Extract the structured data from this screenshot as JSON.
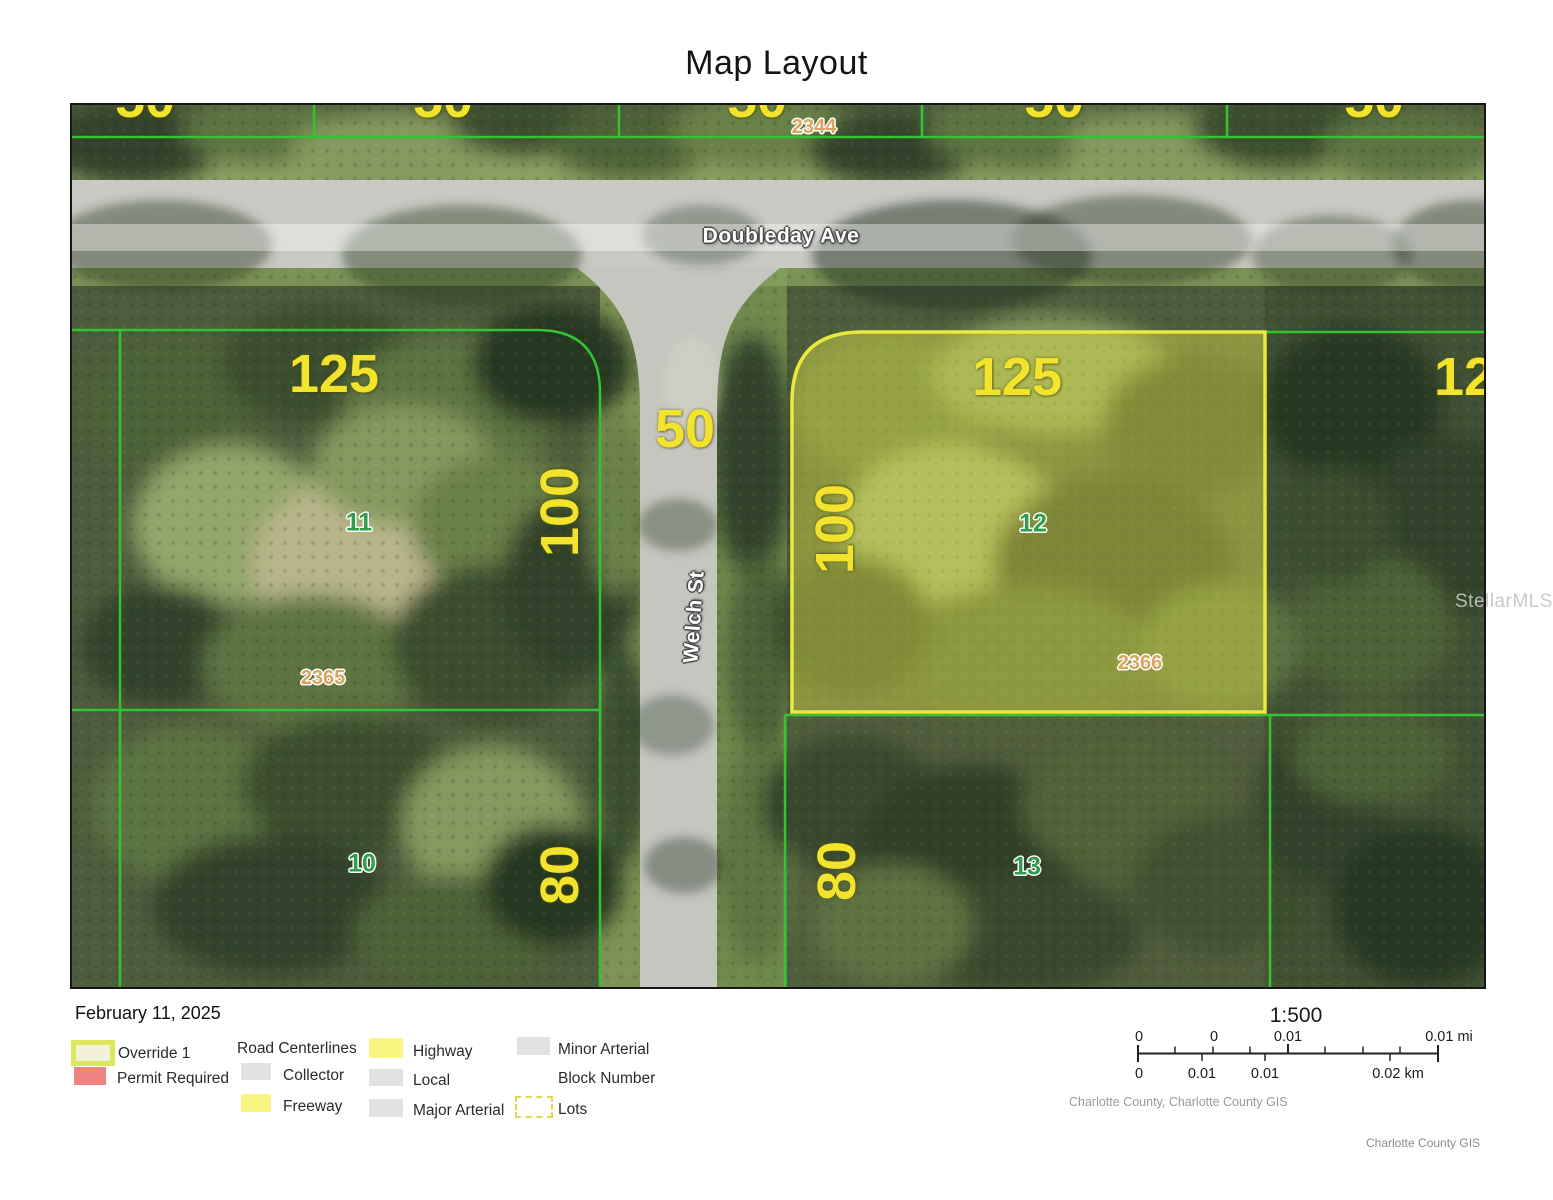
{
  "title": "Map Layout",
  "map": {
    "streets": {
      "horizontal": "Doubleday Ave",
      "vertical": "Welch St"
    },
    "edge_dimension": "50",
    "road_dimension": "50",
    "blocks": {
      "top": "2344"
    },
    "parcels": {
      "lot11": {
        "width": "125",
        "depth": "100",
        "lot": "11",
        "block": "2365"
      },
      "lot12": {
        "width": "125",
        "depth": "100",
        "lot": "12",
        "block": "2366",
        "highlighted": true
      },
      "lot10": {
        "lot": "10",
        "depth": "80"
      },
      "lot13": {
        "lot": "13",
        "depth": "80"
      },
      "right_partial_dimension": "125"
    },
    "watermark": "StellarMLS",
    "colors": {
      "dimension_label": "#f2e32c",
      "lot_label": "#2f9e4a",
      "block_label": "#d9a45f",
      "parcel_line": "#33c433",
      "highlight_fill": "rgba(228,228,72,0.42)",
      "highlight_stroke": "#ebe83e"
    }
  },
  "legend": {
    "date": "February 11, 2025",
    "items": [
      {
        "label": "Override 1",
        "swatch": "override"
      },
      {
        "label": "Permit Required",
        "swatch": "permit"
      },
      {
        "label": "Road Centerlines",
        "swatch": "none"
      },
      {
        "label": "Collector",
        "swatch": "gray"
      },
      {
        "label": "Freeway",
        "swatch": "yellow"
      },
      {
        "label": "Highway",
        "swatch": "yellow"
      },
      {
        "label": "Local",
        "swatch": "gray"
      },
      {
        "label": "Major Arterial",
        "swatch": "gray"
      },
      {
        "label": "Minor Arterial",
        "swatch": "gray"
      },
      {
        "label": "Block Number",
        "swatch": "none"
      },
      {
        "label": "Lots",
        "swatch": "dashed"
      }
    ]
  },
  "scalebar": {
    "ratio": "1:500",
    "mi_labels": [
      "0",
      "0",
      "0.01",
      "0.01 mi"
    ],
    "km_labels": [
      "0",
      "0.01",
      "0.01",
      "0.02 km"
    ]
  },
  "attribution": {
    "inline": "Charlotte County, Charlotte County GIS",
    "corner": "Charlotte County GIS"
  }
}
